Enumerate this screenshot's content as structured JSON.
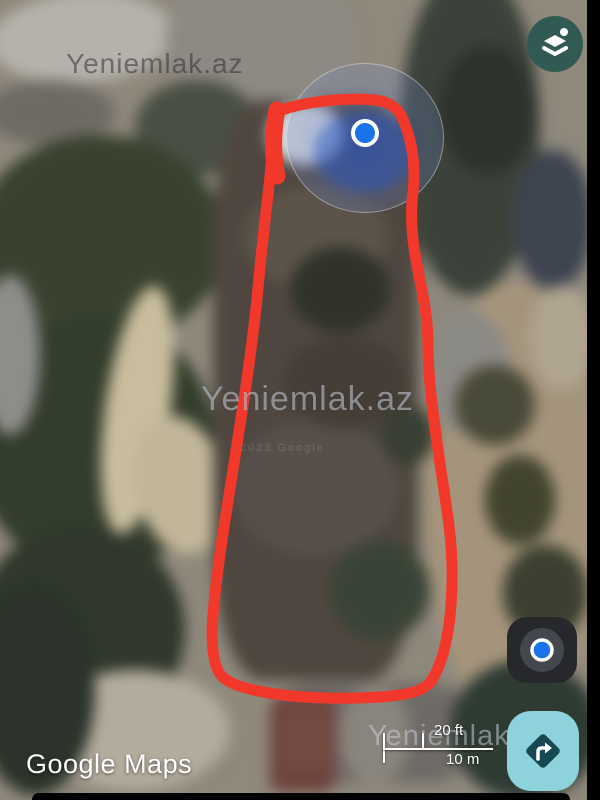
{
  "watermark": {
    "text": "Yeniemlak.az"
  },
  "attribution": {
    "logo": "Google Maps",
    "imagery": "2023 Google"
  },
  "scale_bar": {
    "imperial": "20 ft",
    "metric": "10 m"
  },
  "map": {
    "type": "satellite",
    "annotation": "hand-drawn red outline around land plot",
    "marker": "current-location blue dot with accuracy circle"
  },
  "colors": {
    "outline_red": "#f2382b",
    "location_blue": "#1a73e8",
    "layers_button": "#315a55",
    "my_location_button": "#27282c",
    "my_location_inner": "#44474d",
    "directions_button": "#8ed2dc",
    "directions_diamond": "#174852",
    "icon_white": "#ffffff"
  }
}
